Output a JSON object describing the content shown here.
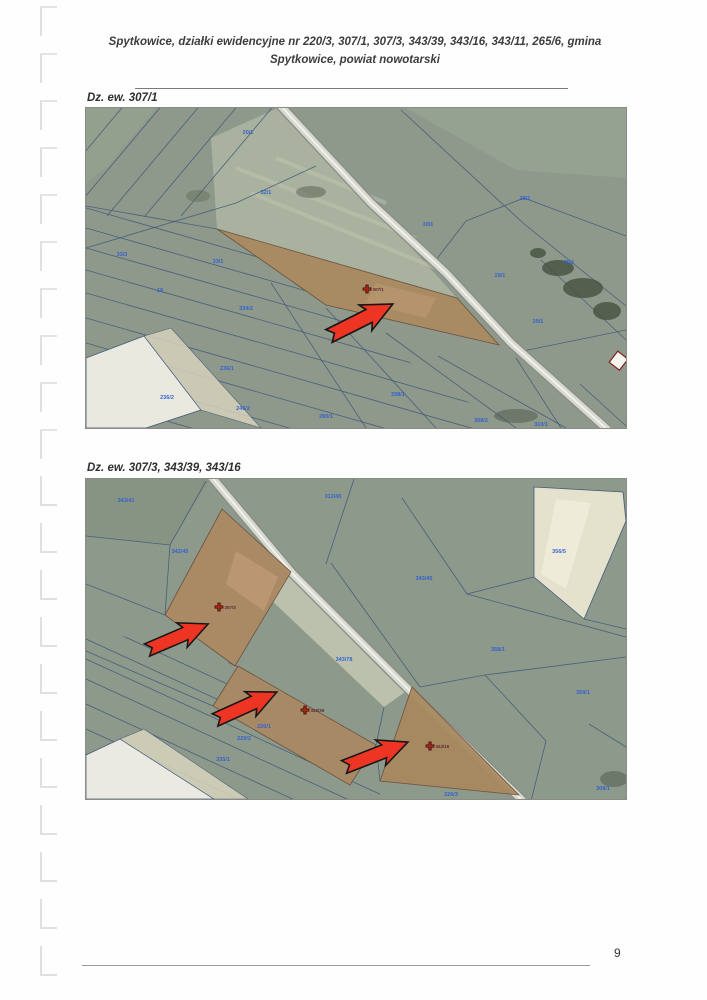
{
  "header": {
    "title": "Spytkowice, działki ewidencyjne nr 220/3, 307/1, 307/3, 343/39, 343/16, 343/11, 265/6, gmina Spytkowice, powiat nowotarski"
  },
  "sections": [
    {
      "label": "Dz. ew. 307/1"
    },
    {
      "label": "Dz. ew. 307/3, 343/39, 343/16"
    }
  ],
  "footer": {
    "page_number": "9"
  },
  "map1": {
    "markers": [
      {
        "x": 281,
        "y": 181,
        "label": "307/1"
      }
    ],
    "parcel_labels": [
      {
        "text": "20/1",
        "x": 162,
        "y": 26
      },
      {
        "text": "32/1",
        "x": 180,
        "y": 86
      },
      {
        "text": "33/3",
        "x": 36,
        "y": 148
      },
      {
        "text": "33/1",
        "x": 132,
        "y": 155
      },
      {
        "text": "18",
        "x": 74,
        "y": 184
      },
      {
        "text": "334/2",
        "x": 160,
        "y": 202
      },
      {
        "text": "236/1",
        "x": 141,
        "y": 262
      },
      {
        "text": "236/2",
        "x": 81,
        "y": 291
      },
      {
        "text": "246/2",
        "x": 157,
        "y": 302
      },
      {
        "text": "280/1",
        "x": 240,
        "y": 310
      },
      {
        "text": "298/1",
        "x": 312,
        "y": 288
      },
      {
        "text": "30/1",
        "x": 342,
        "y": 118
      },
      {
        "text": "28/1",
        "x": 439,
        "y": 92
      },
      {
        "text": "29/1",
        "x": 414,
        "y": 169
      },
      {
        "text": "35/1",
        "x": 483,
        "y": 156
      },
      {
        "text": "39/1",
        "x": 452,
        "y": 215
      },
      {
        "text": "308/2",
        "x": 395,
        "y": 314
      },
      {
        "text": "310/1",
        "x": 455,
        "y": 318
      }
    ]
  },
  "map2": {
    "markers": [
      {
        "x": 133,
        "y": 128,
        "label": "307/3"
      },
      {
        "x": 219,
        "y": 231,
        "label": "343/39"
      },
      {
        "x": 344,
        "y": 267,
        "label": "343/16"
      }
    ],
    "parcel_labels": [
      {
        "text": "343/41",
        "x": 40,
        "y": 23
      },
      {
        "text": "312/45",
        "x": 247,
        "y": 19
      },
      {
        "text": "342/45",
        "x": 94,
        "y": 74
      },
      {
        "text": "343/45",
        "x": 338,
        "y": 101
      },
      {
        "text": "356/5",
        "x": 473,
        "y": 74
      },
      {
        "text": "358/1",
        "x": 412,
        "y": 172
      },
      {
        "text": "343/78",
        "x": 258,
        "y": 182
      },
      {
        "text": "359/1",
        "x": 497,
        "y": 215
      },
      {
        "text": "220/1",
        "x": 178,
        "y": 249
      },
      {
        "text": "220/2",
        "x": 158,
        "y": 261
      },
      {
        "text": "335/1",
        "x": 137,
        "y": 282
      },
      {
        "text": "220/3",
        "x": 365,
        "y": 317
      },
      {
        "text": "308/1",
        "x": 517,
        "y": 311
      }
    ]
  },
  "colors": {
    "arrow_red": "#ee3524",
    "boundary_blue": "#41597a",
    "label_blue": "#2f5fd0",
    "highlight_brown": "#aa8a61",
    "road_gray": "#d7d8d0"
  }
}
